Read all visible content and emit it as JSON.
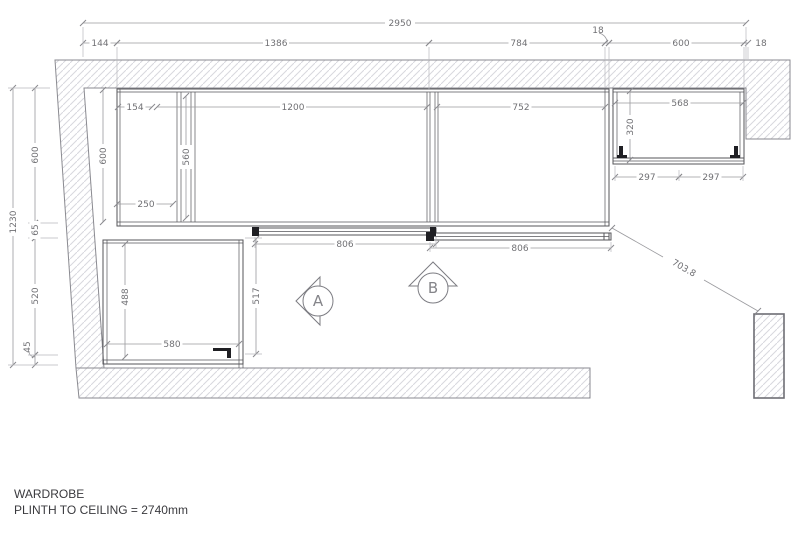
{
  "drawing": {
    "title_line1": "WARDROBE",
    "title_line2": "PLINTH TO CEILING = 2740mm"
  },
  "markers": {
    "a": "A",
    "b": "B"
  },
  "dims": {
    "overall_width": "2950",
    "top_144": "144",
    "top_1386": "1386",
    "top_784": "784",
    "top_18a": "18",
    "top_600": "600",
    "top_18b": "18",
    "left_total": "1230",
    "left_600": "600",
    "left_65": "65",
    "left_520": "520",
    "left_45": "45",
    "depth_600": "600",
    "u154": "154",
    "u1200": "1200",
    "u752": "752",
    "u560": "560",
    "u250": "250",
    "wc568": "568",
    "wc320": "320",
    "wc297a": "297",
    "wc297b": "297",
    "door806a": "806",
    "door806b": "806",
    "lc488": "488",
    "lc580": "580",
    "lc517": "517",
    "diag703": "703.8"
  },
  "colors": {
    "wall-line": "#8a8a90",
    "hatch-line": "#d8d8de",
    "cab-line": "#55555a",
    "dim-line": "#9a9a9e",
    "dim-text": "#707074",
    "title-text": "#3a3a3e",
    "hardware": "#1f1f23",
    "marker-line": "#7c7c82"
  }
}
